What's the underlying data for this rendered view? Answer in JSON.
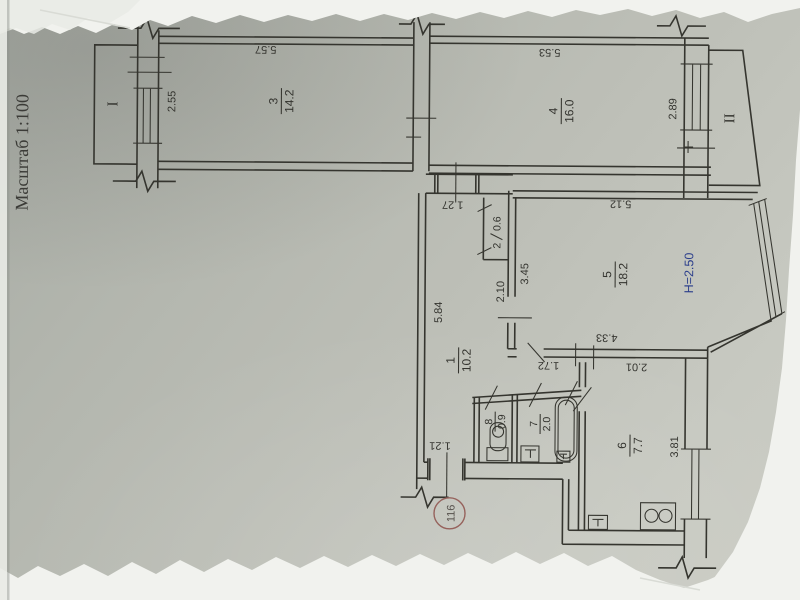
{
  "document": {
    "scale_label": "Масштаб 1:100",
    "apartment_number": "116",
    "ceiling_height_label": "H=2.50",
    "balcony_1_label": "I",
    "balcony_2_label": "II"
  },
  "colors": {
    "ink": "#35352f",
    "blue_height_note": "#2c3f8c",
    "red_stamp": "#96625c",
    "paper": "#b9bcb4",
    "torn_edge_white": "#f1f2ee"
  },
  "rooms": {
    "corridor": {
      "number": "1",
      "area": "10.2"
    },
    "closet": {
      "number": "2",
      "area": "0.6"
    },
    "living1": {
      "number": "3",
      "area": "14.2"
    },
    "living2": {
      "number": "4",
      "area": "16.0"
    },
    "living3": {
      "number": "5",
      "area": "18.2"
    },
    "kitchen": {
      "number": "6",
      "area": "7.7"
    },
    "bathroom": {
      "number": "7",
      "area": "2.0"
    },
    "wc": {
      "number": "8",
      "area": "0.9"
    }
  },
  "dimensions": {
    "room3_length": "5.57",
    "room3_width": "2.55",
    "room4_length": "5.53",
    "room4_width": "2.89",
    "room5_length": "5.12",
    "room5_left": "3.45",
    "room5_bottom": "4.33",
    "corridor_length": "5.84",
    "corridor_opening": "1.27",
    "corridor_width": "2.10",
    "hall_width": "1.72",
    "kitchen_width": "2.01",
    "kitchen_length": "3.81",
    "entrance_width": "1.21"
  }
}
